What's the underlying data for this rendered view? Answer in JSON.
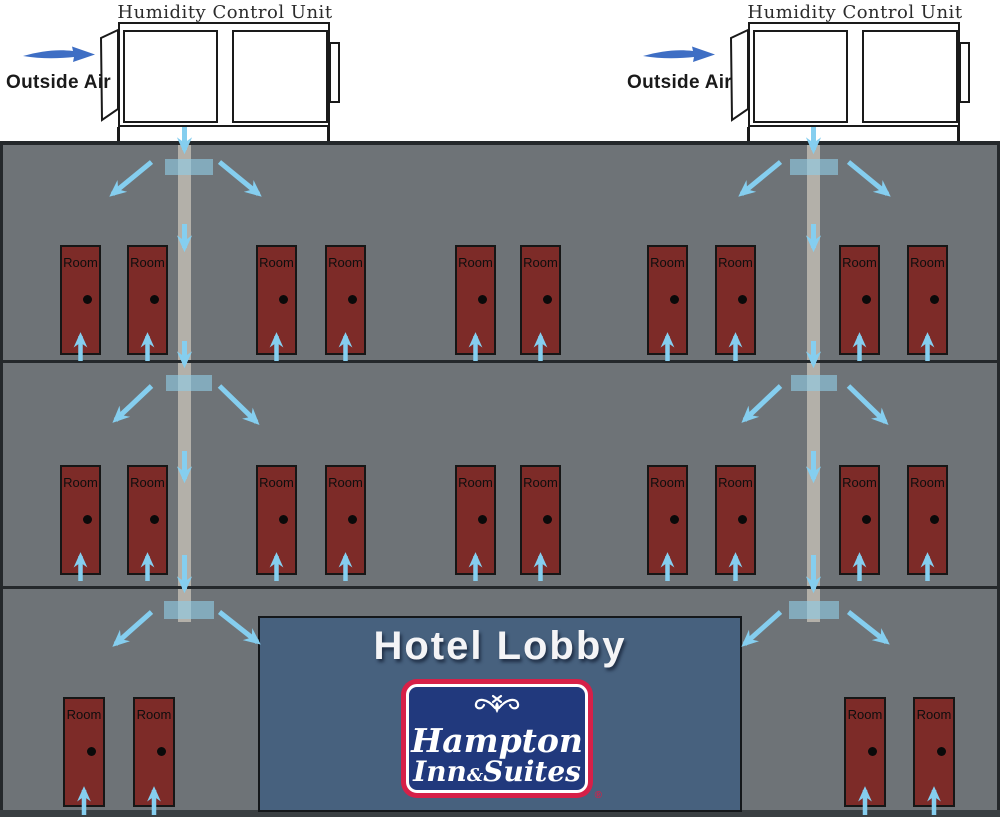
{
  "diagram": {
    "units": {
      "left": {
        "title": "Humidity Control Unit",
        "outside_air_label": "Outside Air"
      },
      "right": {
        "title": "Humidity Control Unit",
        "outside_air_label": "Outside Air"
      }
    },
    "building": {
      "room_label": "Room",
      "floors": [
        {
          "doors": 10
        },
        {
          "doors": 10
        },
        {
          "doors": 4
        }
      ]
    },
    "lobby": {
      "title": "Hotel Lobby",
      "logo": {
        "name": "Hampton Inn & Suites",
        "line1": "Hampton",
        "line2_inn": "Inn",
        "line2_amp": "&",
        "line2_suites": "Suites",
        "registered": "®"
      }
    },
    "colors": {
      "wall": "#6e7377",
      "door_red": "#7d2b28",
      "duct": "#b3b0a9",
      "diffuser_blue": "#8fcce5",
      "airflow_arrow": "#85ceef",
      "outside_air_arrow": "#3e6ec4",
      "lobby_blue": "#47617e",
      "logo_navy": "#21397d",
      "logo_red": "#d62048"
    }
  }
}
